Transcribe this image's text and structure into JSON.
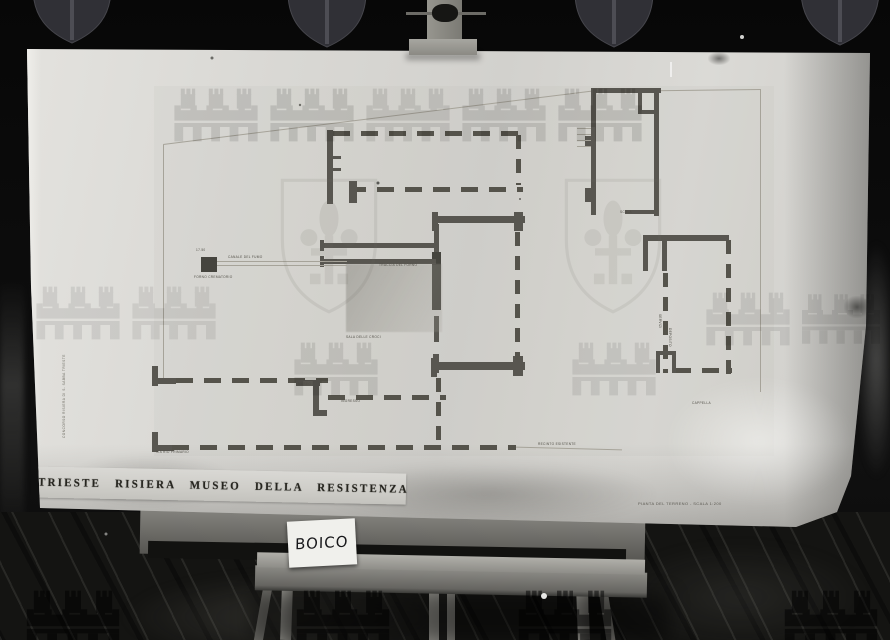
{
  "photo": {
    "subject": "archival photograph of an architectural plan on a wooden easel",
    "card_label": "BOICO",
    "title_strip": "TRIESTE RISIERA MUSEO DELLA RESISTENZA",
    "caption_bottom_right": "PIANTA DEL TERRENO - SCALA 1:200",
    "side_annotation": "CONCORSO RISIERA DI S. SABBA TRIESTE"
  },
  "plan": {
    "labels": [
      {
        "text": "17.50"
      },
      {
        "text": "CANALE DEL FUMO"
      },
      {
        "text": "FORNO CREMATORIO"
      },
      {
        "text": "TRACCIA DEL FORNO"
      },
      {
        "text": "SALA DELLE CROCI"
      },
      {
        "text": "MUSEO"
      },
      {
        "text": "INGRESSO"
      },
      {
        "text": "VIA RIO PRIMARIO"
      },
      {
        "text": "RECINTO ESISTENTE"
      },
      {
        "text": "CAPPELLA"
      },
      {
        "text": "SCALA"
      },
      {
        "text": "SERVIZI"
      },
      {
        "text": "DEPOSITO"
      }
    ]
  },
  "colors": {
    "background": "#0a0a0a",
    "board": "#d9d8d4",
    "wall_ink": "#585650",
    "watermark_dark": "#303036",
    "watermark_faint": "#6e6c64",
    "watermark_floor": "#84848c"
  },
  "watermark": {
    "motifs": [
      "heater-shield-with-fleur-de-lis",
      "mural-crown-with-towers"
    ]
  }
}
